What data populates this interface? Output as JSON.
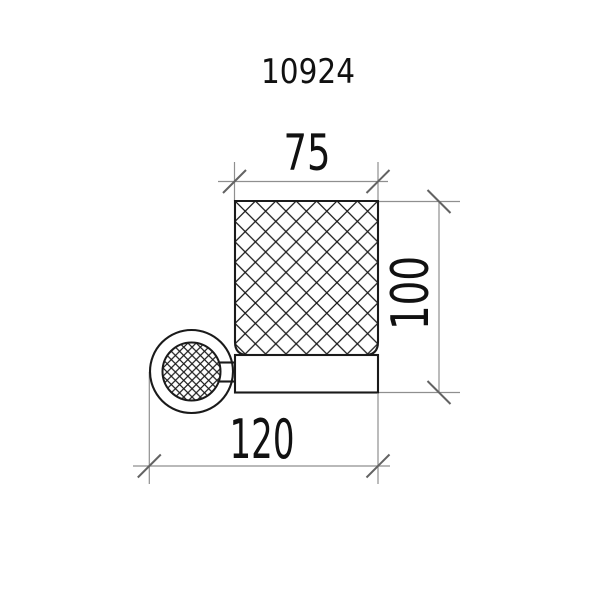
{
  "title": "10924",
  "dimensions": {
    "width_top": "75",
    "height_right": "100",
    "width_bottom": "120"
  },
  "components": {
    "glass": "crosshatched-tumbler-glass",
    "holder": "holder-ring-band",
    "mount": "wall-mount-rosette"
  },
  "colors": {
    "background": "#ffffff",
    "object_line": "#1a1a1a",
    "dimension_line": "#8f8f8f",
    "tick_mark": "#636363",
    "text": "#111111"
  }
}
